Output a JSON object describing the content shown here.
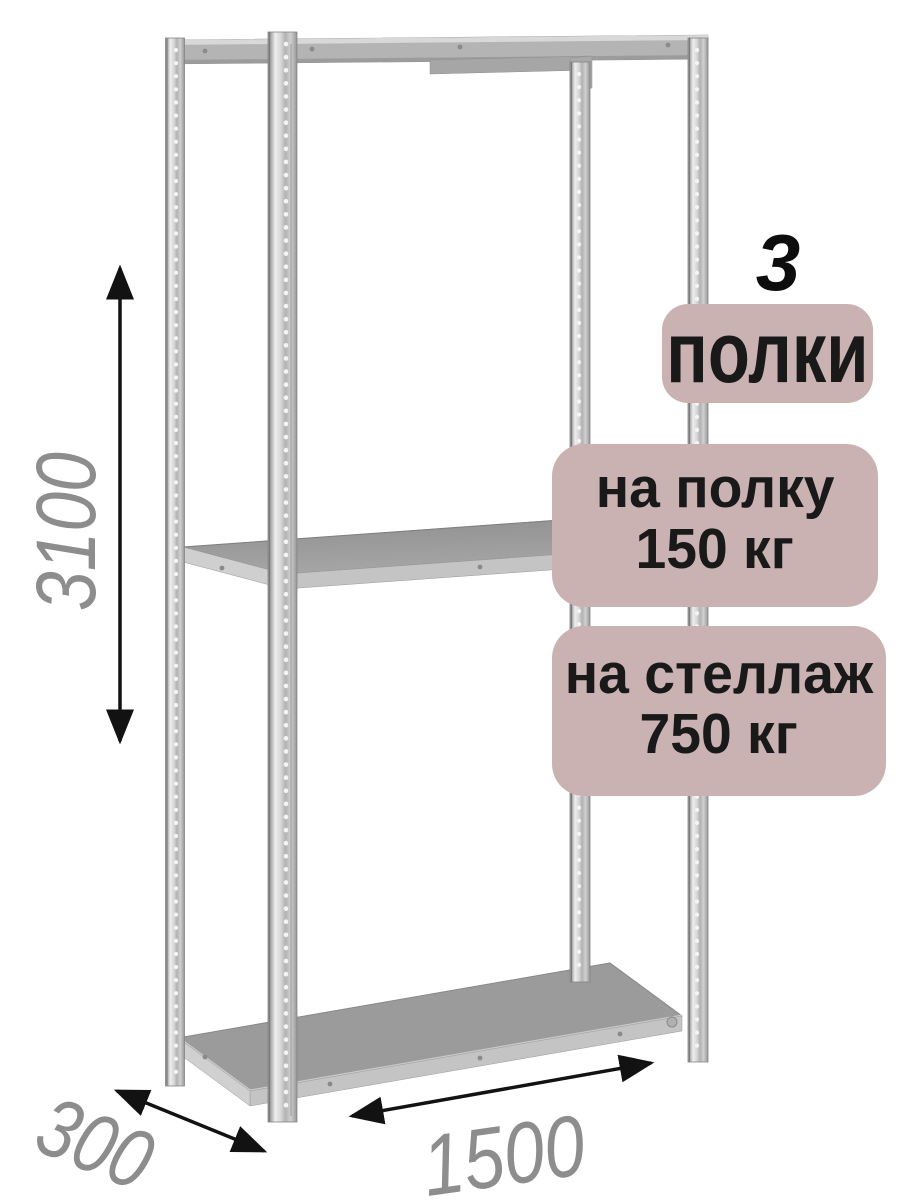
{
  "annotations": {
    "shelf_count_number": "3",
    "shelf_count_label": "полки",
    "shelf_load": {
      "line1": "на полку",
      "line2": "150 кг"
    },
    "rack_load": {
      "line1": "на стеллаж",
      "line2": "750 кг"
    }
  },
  "dimensions": {
    "height_mm": "3100",
    "depth_mm": "300",
    "width_mm": "1500"
  },
  "illustration": {
    "shelves_visible": 3,
    "posts_visible": 4
  },
  "colors": {
    "badge_bg": "#cab2b2",
    "badge_text": "#191919",
    "dimension_text": "#8d8d8d",
    "arrow": "#121212",
    "metal_light": "#d6d6d6",
    "metal_mid": "#9c9c9c",
    "background": "#ffffff"
  }
}
